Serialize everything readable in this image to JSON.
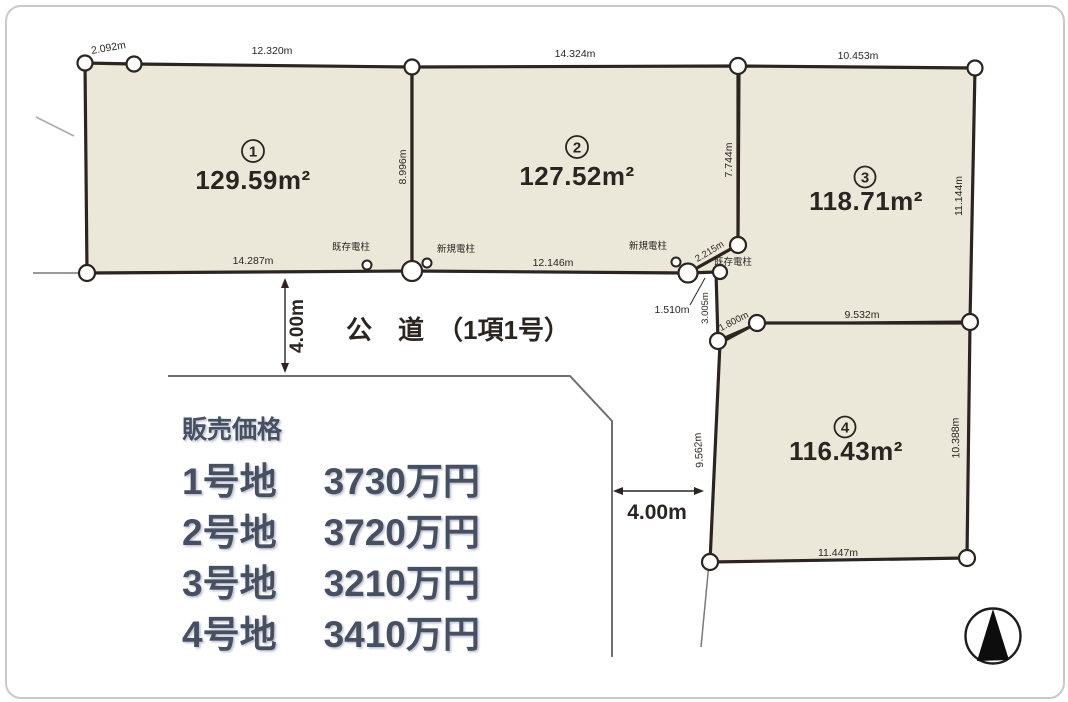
{
  "road": {
    "label": "公　道　（1項1号）",
    "width_vertical": "4.00m",
    "width_horizontal": "4.00m"
  },
  "plots": [
    {
      "num": "1",
      "area": "129.59m²"
    },
    {
      "num": "2",
      "area": "127.52m²"
    },
    {
      "num": "3",
      "area": "118.71m²"
    },
    {
      "num": "4",
      "area": "116.43m²"
    }
  ],
  "measurements": {
    "p1_corner": "2.092m",
    "p1_top": "12.320m",
    "p1_bottom": "14.287m",
    "p12_side": "8.996m",
    "p2_top": "14.324m",
    "p2_bottom": "12.146m",
    "p23_side": "7.744m",
    "p3_top": "10.453m",
    "p3_right": "11.144m",
    "p3_bottom": "9.532m",
    "p4_left": "9.562m",
    "p4_right": "10.388m",
    "p4_bottom": "11.447m",
    "j_diagonal": "2.215m",
    "j_short": "1.510m",
    "j_vertical": "3.005m",
    "j_diagonal2": "1.800m"
  },
  "poles": {
    "existing1": "既存電柱",
    "new1": "新規電柱",
    "new2": "新規電柱",
    "existing2": "既存電柱"
  },
  "pricing": {
    "heading": "販売価格",
    "rows": [
      {
        "lot": "1号地",
        "price": "3730万円"
      },
      {
        "lot": "2号地",
        "price": "3720万円"
      },
      {
        "lot": "3号地",
        "price": "3210万円"
      },
      {
        "lot": "4号地",
        "price": "3410万円"
      }
    ]
  },
  "colors": {
    "plot_fill": "#ece8d9",
    "line_dark": "#2b2421",
    "price_text": "#475061"
  }
}
